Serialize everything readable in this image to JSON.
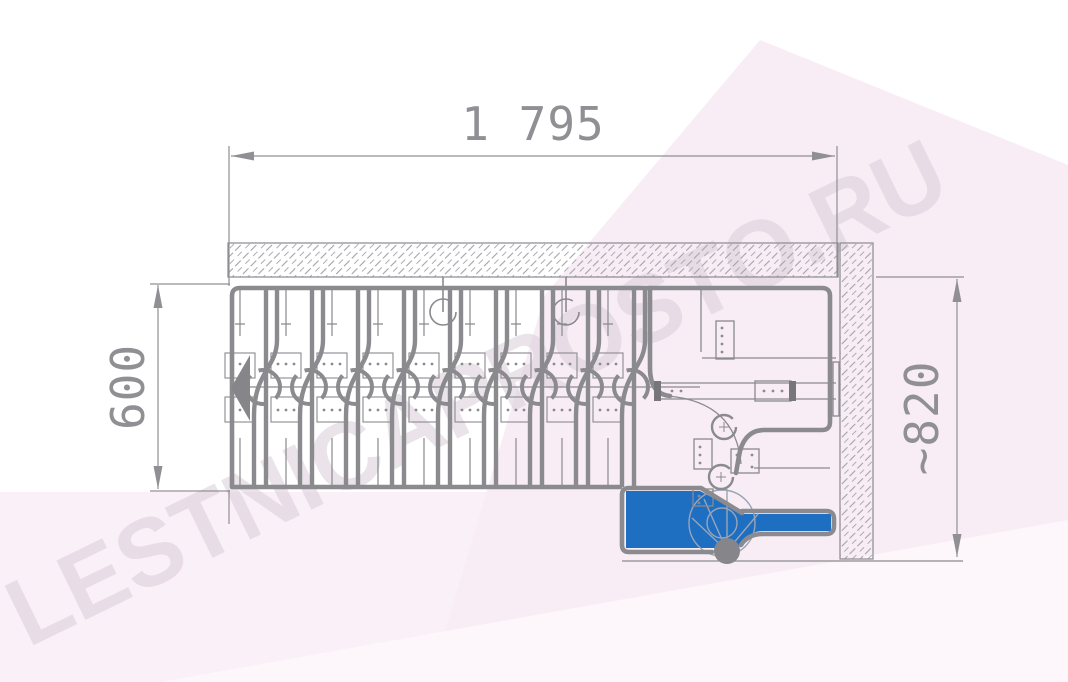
{
  "watermark": {
    "text": "LESTNICAPROSTO.RU"
  },
  "dimensions": {
    "top_width_label": "1 795",
    "left_depth_label": "600",
    "right_width_label": "~820"
  },
  "stairs": {
    "type": "modular-staircase-plan-view",
    "straight_step_modules": 9,
    "turn_joint_circles": 2,
    "ceiling_anchor_circles": 2,
    "highlighted_first_step_color": "#1e6fc2",
    "line_color": "#8a8a8f",
    "dim_color": "#8f8f94",
    "wall_hatch_color": "#a3a3a8",
    "background_pink": "#f8edf5",
    "watermark_color": "#ded2dc"
  }
}
